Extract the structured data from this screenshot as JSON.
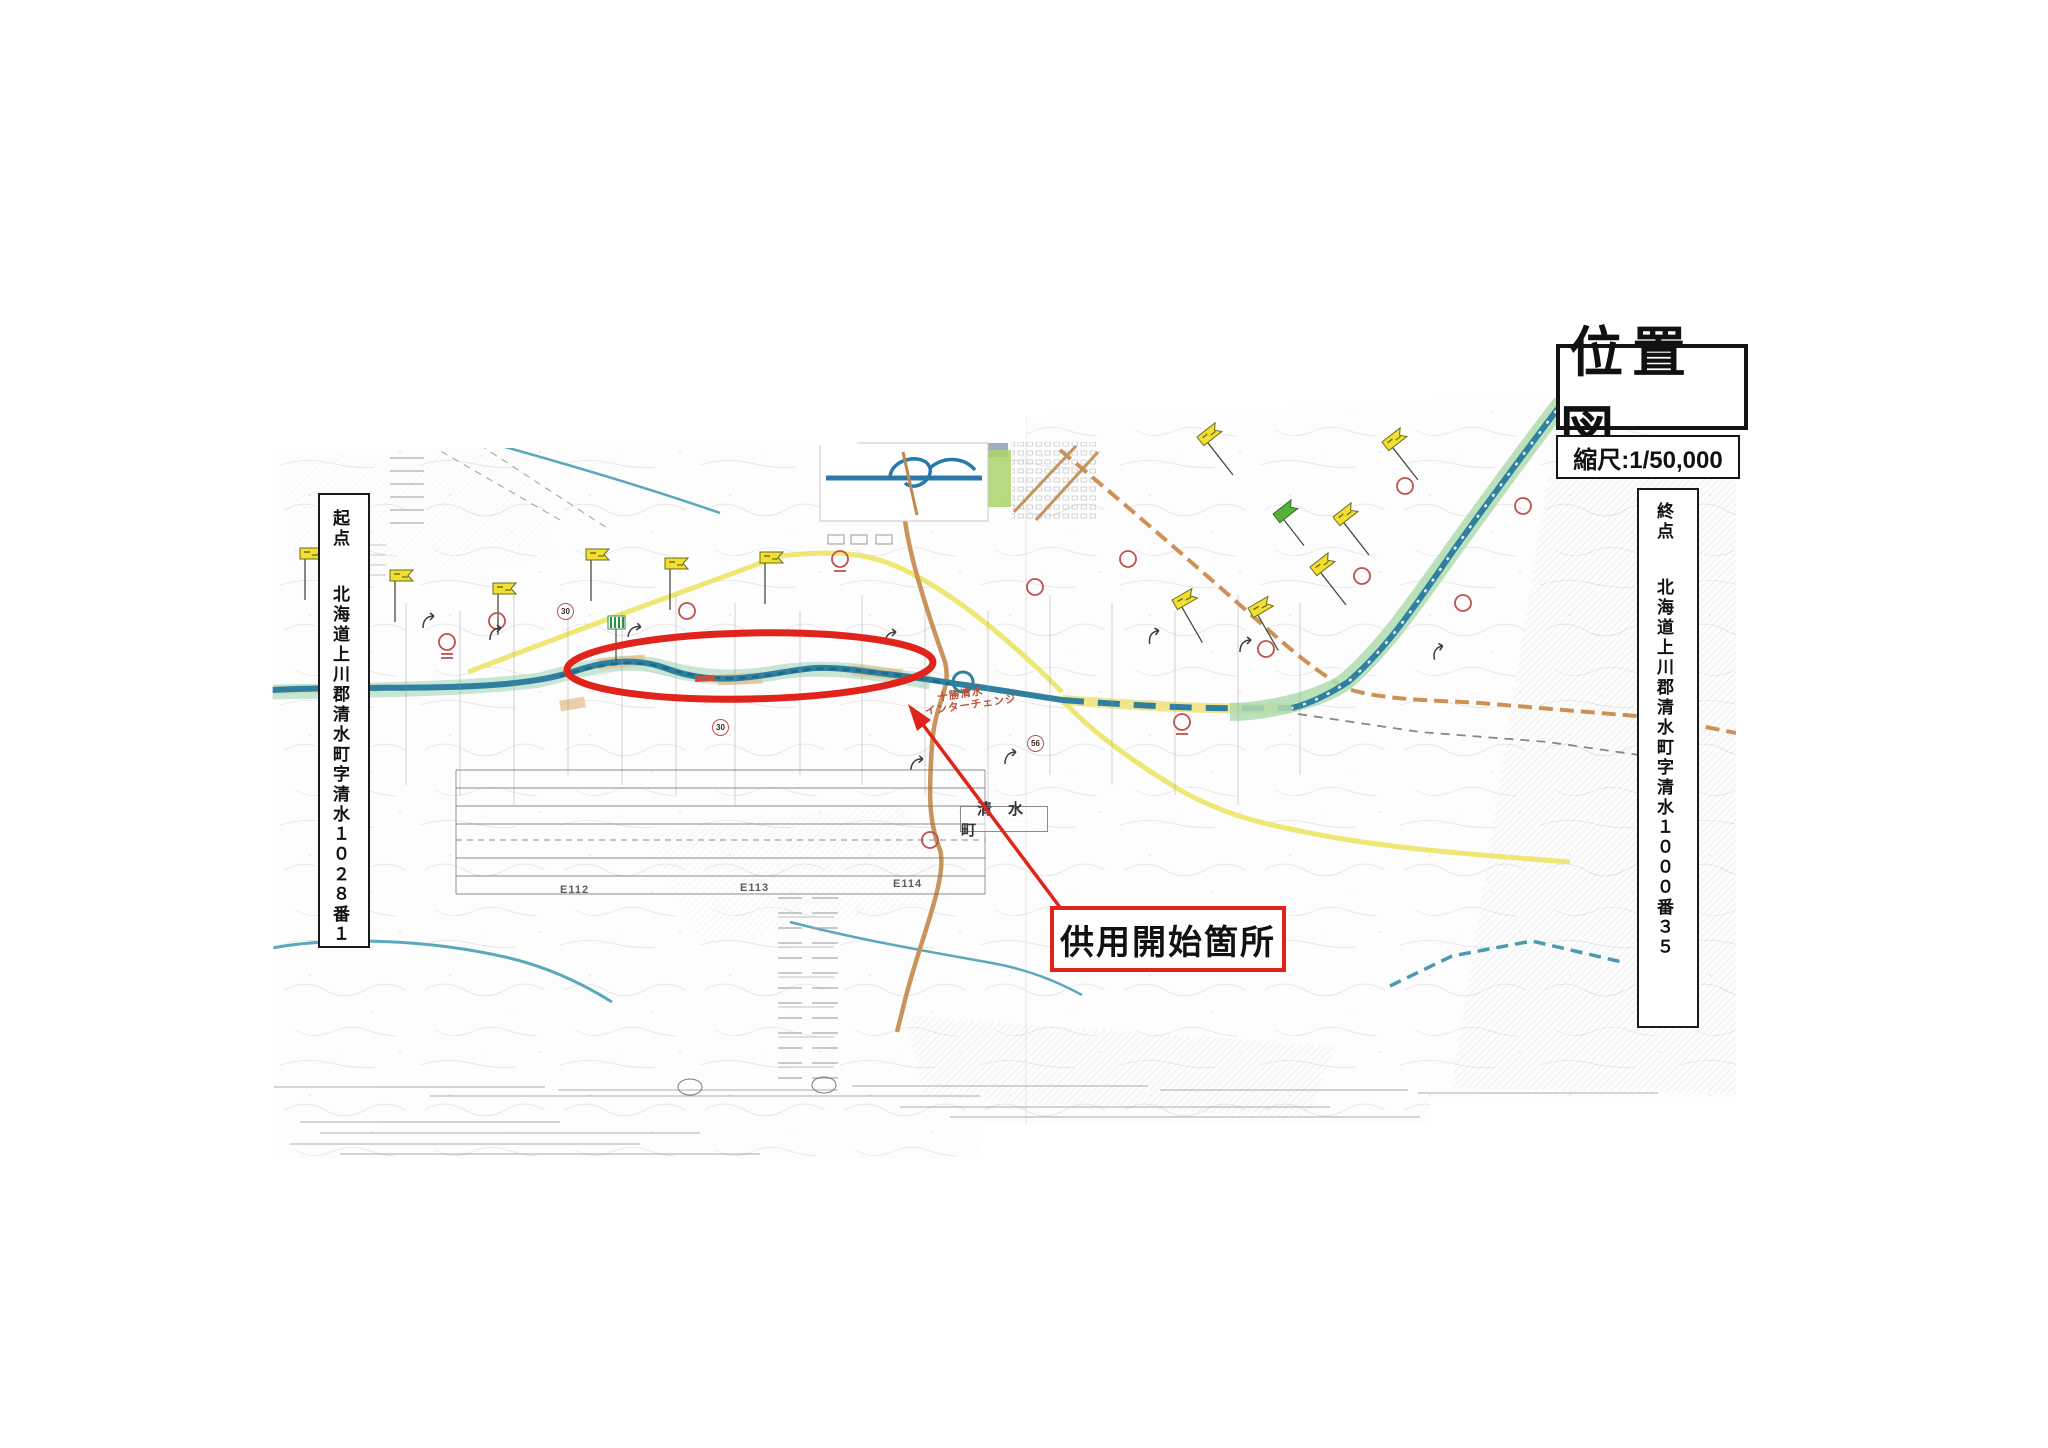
{
  "title": {
    "text": "位置図"
  },
  "scale": {
    "text": "縮尺:1/50,000"
  },
  "endpoints": {
    "start": {
      "heading": "起点",
      "address": "北海道上川郡清水町字清水１０２８番１"
    },
    "end": {
      "heading": "終点",
      "address": "北海道上川郡清水町字清水１０００番３５"
    }
  },
  "callout": {
    "text": "供用開始箇所"
  },
  "map_labels": {
    "interchange_line1": "十勝清水",
    "interchange_line2": "インターチェンジ",
    "town": "清水町",
    "grid": [
      "E112",
      "E113",
      "E114"
    ],
    "route_30": "30",
    "route_56": "56"
  },
  "colors": {
    "highlight_red": "#e0241c",
    "route_blue": "#2e7fa0",
    "route_glow_green": "#b7dcc6",
    "expressway_glow": "#aedcae",
    "road_yellow": "#ece464",
    "railway_orange": "#cf9055",
    "road_brown": "#c9935a",
    "flag_yellow": "#f2df30",
    "paper": "#fdfdfd"
  }
}
